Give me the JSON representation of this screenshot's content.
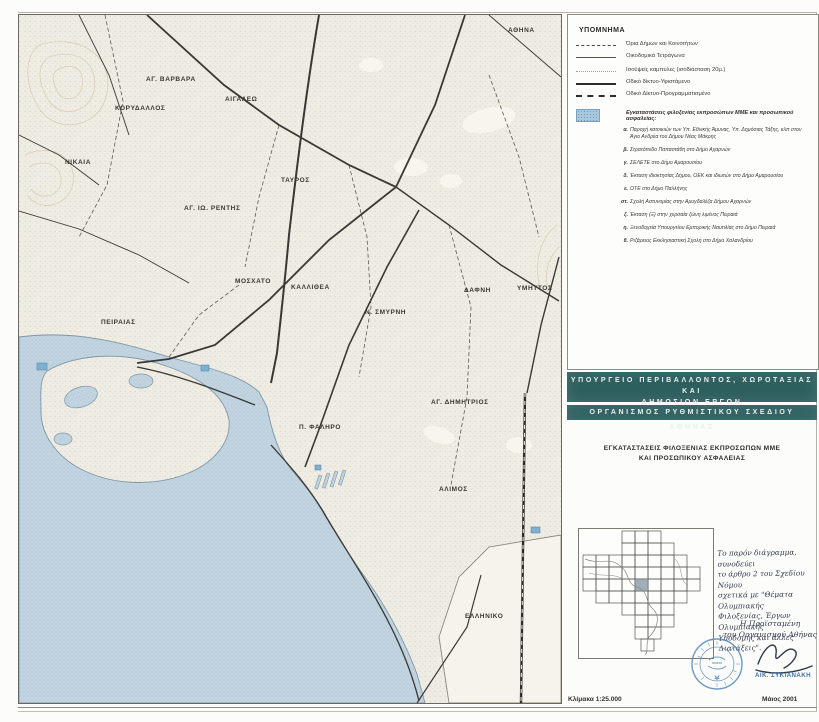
{
  "legend": {
    "title": "ΥΠΟΜΝΗΜΑ",
    "items": [
      {
        "symbol": "boundary-dashed-line",
        "label": "Όρια Δήμων και Κοινοτήτων"
      },
      {
        "symbol": "thin-solid-line",
        "label": "Οικοδομικά Τετράγωνα"
      },
      {
        "symbol": "dotted-line",
        "label": "Ισοϋψείς καμπύλες (ισοδιάσταση 20μ.)"
      },
      {
        "symbol": "thick-solid-line",
        "label": "Οδικό δίκτυο-Υφιστάμενο"
      },
      {
        "symbol": "thick-dashed-line",
        "label": "Οδικό Δίκτυο-Προγραμματισμένο"
      }
    ],
    "facility_header": "Εγκαταστάσεις φιλοξενίας εκπροσώπων ΜΜΕ και προσωπικού ασφαλείας:",
    "facility_items": [
      {
        "letter": "α.",
        "text": "Παροχή κατοικιών των Υπ. Εθνικής Άμυνας, Υπ. Δημόσιας Τάξης, κλπ στον Άγιο Ανδρέα του Δήμου Νέας Μάκρης"
      },
      {
        "letter": "β.",
        "text": "Στρατόπεδο Παπαστάθη στο Δήμο Αχαρνών"
      },
      {
        "letter": "γ.",
        "text": "ΣΕΛΕΤΕ στο Δήμο Αμαρουσίου"
      },
      {
        "letter": "δ.",
        "text": "Έκταση ιδιοκτησίας Δήμου, ΟΕΚ και ιδιωτών στο Δήμο Αμαρουσίου"
      },
      {
        "letter": "ε.",
        "text": "ΟΤΕ στο Δήμο Παλλήνης"
      },
      {
        "letter": "στ.",
        "text": "Σχολή Αστυνομίας στην Αμυγδαλέζα Δήμου Αχαρνών"
      },
      {
        "letter": "ζ.",
        "text": "Έκταση (Ξ) στην χερσαία ζώνη λιμένος Πειραιά"
      },
      {
        "letter": "η.",
        "text": "Ξενοδοχεία Υπουργείου Εμπορικής Ναυτιλίας στο Δήμο Πειραιά"
      },
      {
        "letter": "θ.",
        "text": "Ριζάρειος Εκκλησιαστική Σχολή στο Δήμο Χαλανδρίου"
      }
    ]
  },
  "title_block": {
    "ministry_line1": "ΥΠΟΥΡΓΕΙΟ ΠΕΡΙΒΑΛΛΟΝΤΟΣ, ΧΩΡΟΤΑΞΙΑΣ ΚΑΙ",
    "ministry_line2": "ΔΗΜΟΣΙΩΝ ΕΡΓΩΝ",
    "organization": "ΟΡΓΑΝΙΣΜΟΣ ΡΥΘΜΙΣΤΙΚΟΥ ΣΧΕΔΙΟΥ ΑΘΗΝΑΣ",
    "map_title_line1": "ΕΓΚΑΤΑΣΤΑΣΕΙΣ ΦΙΛΟΞΕΝΙΑΣ ΕΚΠΡΟΣΩΠΩΝ ΜΜΕ",
    "map_title_line2": "ΚΑΙ ΠΡΟΣΩΠΙΚΟΥ ΑΣΦΑΛΕΙΑΣ"
  },
  "note": {
    "lines": [
      "Το παρόν διάγραμμα, συνοδεύει",
      "το άρθρο 2 του Σχεδίου Νόμου",
      "σχετικά με \"Θέματα Ολυμπιακής",
      "Φιλοξενίας, Έργων Ολυμπιακής",
      "Υποδομής και άλλες Διατάξεις\"."
    ],
    "signoff_line1": "Η Προϊσταμένη",
    "signoff_line2": "του Οργανισμού Αθήνας",
    "signer_name": "ΑΙΚ. ΣΥΚΙΑΝΑΚΗ"
  },
  "footer": {
    "scale": "Κλίμακα 1:25.000",
    "date": "Μάιος 2001"
  },
  "map": {
    "labels": [
      {
        "text": "ΑΘΗΝΑ"
      },
      {
        "text": "ΑΓ. ΒΑΡΒΑΡΑ"
      },
      {
        "text": "ΚΟΡΥΔΑΛΛΟΣ"
      },
      {
        "text": "ΑΙΓΑΛΕΩ"
      },
      {
        "text": "ΝΙΚΑΙΑ"
      },
      {
        "text": "ΤΑΥΡΟΣ"
      },
      {
        "text": "ΑΓ. ΙΩ. ΡΕΝΤΗΣ"
      },
      {
        "text": "ΜΟΣΧΑΤΟ"
      },
      {
        "text": "ΚΑΛΛΙΘΕΑ"
      },
      {
        "text": "Ν. ΣΜΥΡΝΗ"
      },
      {
        "text": "ΔΑΦΝΗ"
      },
      {
        "text": "ΥΜΗΤΤΟΣ"
      },
      {
        "text": "ΠΕΙΡΑΙΑΣ"
      },
      {
        "text": "Π. ΦΑΛΗΡΟ"
      },
      {
        "text": "ΑΓ. ΔΗΜΗΤΡΙΟΣ"
      },
      {
        "text": "ΑΛΙΜΟΣ"
      },
      {
        "text": "ΕΛΛΗΝΙΚΟ"
      }
    ]
  },
  "colors": {
    "teal_bar": "#2e5f5f",
    "water": "#c2d4e0",
    "facility_blue": "#a9c8de",
    "stamp_blue": "#5288ba",
    "signer_blue": "#3f74ad"
  }
}
